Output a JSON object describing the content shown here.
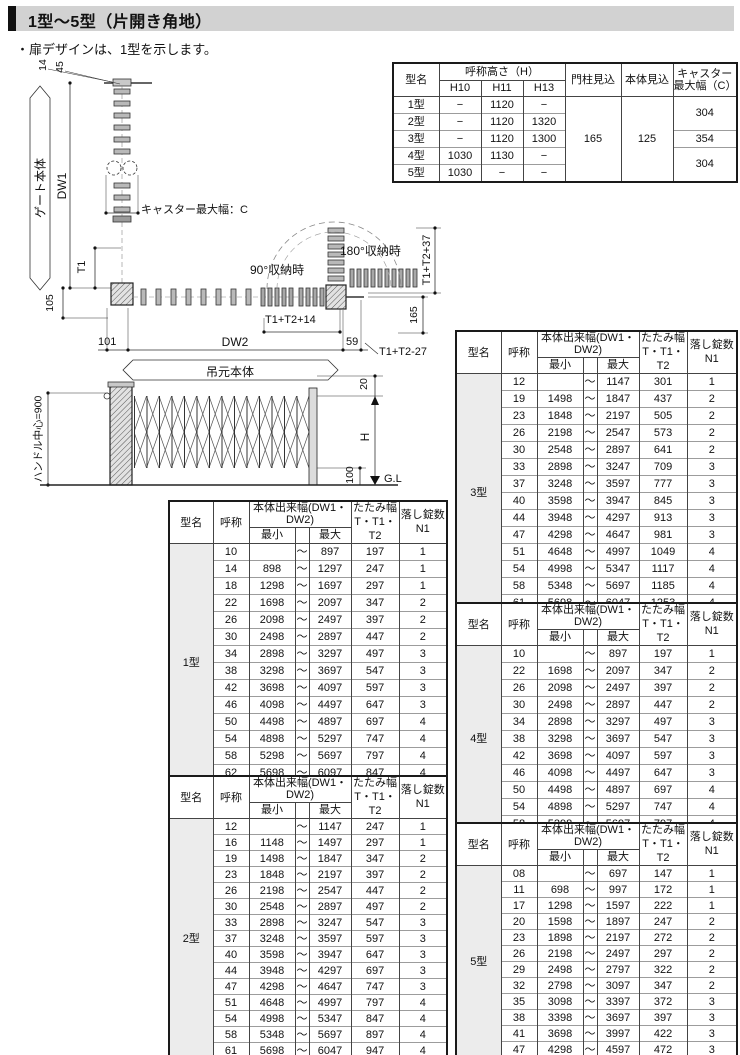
{
  "header": {
    "title": "1型～5型（片開き角地）",
    "note": "・扉デザインは、1型を示します。"
  },
  "spec_table": {
    "col_model": "型名",
    "col_height": "呼称高さ（H）",
    "sub_cols": [
      "H10",
      "H11",
      "H13"
    ],
    "col_pillar": "門柱見込",
    "col_body": "本体見込",
    "col_caster": "キャスター最大幅（C）",
    "rows": [
      [
        "1型",
        "−",
        "1120",
        "−"
      ],
      [
        "2型",
        "−",
        "1120",
        "1320"
      ],
      [
        "3型",
        "−",
        "1120",
        "1300"
      ],
      [
        "4型",
        "1030",
        "1130",
        "−"
      ],
      [
        "5型",
        "1030",
        "−",
        "−"
      ]
    ],
    "pillar": "165",
    "body": "125",
    "caster": [
      "304",
      "354",
      "304"
    ]
  },
  "diagram": {
    "gate_body": "ゲート本体",
    "dim14": "14",
    "dim45": "45",
    "dw1": "DW1",
    "caster_width": "キャスター最大幅：C",
    "t1": "T1",
    "dim105": "105",
    "store90": "90°収納時",
    "store180": "180°収納時",
    "t1t2p37": "T1+T2+37",
    "t1t2p14": "T1+T2+14",
    "dim165": "165",
    "dim101": "101",
    "dw2": "DW2",
    "dim59": "59",
    "t1t2m27": "T1+T2-27",
    "hang_body": "吊元本体",
    "handle_center": "ハンドル中心=900",
    "dim20": "20",
    "h": "H",
    "dim100": "100",
    "gl": "G.L"
  },
  "size_header": {
    "model": "型名",
    "name": "呼称",
    "width": "本体出来幅(DW1・DW2)",
    "min": "最小",
    "max": "最大",
    "fold1": "たたみ幅",
    "fold2": "T・T1・T2",
    "lock1": "落し錠数",
    "lock2": "N1",
    "tilde": "～"
  },
  "size_tables": [
    {
      "model": "1型",
      "rows": [
        [
          "10",
          "",
          "897",
          "197",
          "1"
        ],
        [
          "14",
          "898",
          "1297",
          "247",
          "1"
        ],
        [
          "18",
          "1298",
          "1697",
          "297",
          "1"
        ],
        [
          "22",
          "1698",
          "2097",
          "347",
          "2"
        ],
        [
          "26",
          "2098",
          "2497",
          "397",
          "2"
        ],
        [
          "30",
          "2498",
          "2897",
          "447",
          "2"
        ],
        [
          "34",
          "2898",
          "3297",
          "497",
          "3"
        ],
        [
          "38",
          "3298",
          "3697",
          "547",
          "3"
        ],
        [
          "42",
          "3698",
          "4097",
          "597",
          "3"
        ],
        [
          "46",
          "4098",
          "4497",
          "647",
          "3"
        ],
        [
          "50",
          "4498",
          "4897",
          "697",
          "4"
        ],
        [
          "54",
          "4898",
          "5297",
          "747",
          "4"
        ],
        [
          "58",
          "5298",
          "5697",
          "797",
          "4"
        ],
        [
          "62",
          "5698",
          "6097",
          "847",
          "4"
        ]
      ]
    },
    {
      "model": "2型",
      "rows": [
        [
          "12",
          "",
          "1147",
          "247",
          "1"
        ],
        [
          "16",
          "1148",
          "1497",
          "297",
          "1"
        ],
        [
          "19",
          "1498",
          "1847",
          "347",
          "2"
        ],
        [
          "23",
          "1848",
          "2197",
          "397",
          "2"
        ],
        [
          "26",
          "2198",
          "2547",
          "447",
          "2"
        ],
        [
          "30",
          "2548",
          "2897",
          "497",
          "2"
        ],
        [
          "33",
          "2898",
          "3247",
          "547",
          "3"
        ],
        [
          "37",
          "3248",
          "3597",
          "597",
          "3"
        ],
        [
          "40",
          "3598",
          "3947",
          "647",
          "3"
        ],
        [
          "44",
          "3948",
          "4297",
          "697",
          "3"
        ],
        [
          "47",
          "4298",
          "4647",
          "747",
          "3"
        ],
        [
          "51",
          "4648",
          "4997",
          "797",
          "4"
        ],
        [
          "54",
          "4998",
          "5347",
          "847",
          "4"
        ],
        [
          "58",
          "5348",
          "5697",
          "897",
          "4"
        ],
        [
          "61",
          "5698",
          "6047",
          "947",
          "4"
        ]
      ]
    },
    {
      "model": "3型",
      "rows": [
        [
          "12",
          "",
          "1147",
          "301",
          "1"
        ],
        [
          "19",
          "1498",
          "1847",
          "437",
          "2"
        ],
        [
          "23",
          "1848",
          "2197",
          "505",
          "2"
        ],
        [
          "26",
          "2198",
          "2547",
          "573",
          "2"
        ],
        [
          "30",
          "2548",
          "2897",
          "641",
          "2"
        ],
        [
          "33",
          "2898",
          "3247",
          "709",
          "3"
        ],
        [
          "37",
          "3248",
          "3597",
          "777",
          "3"
        ],
        [
          "40",
          "3598",
          "3947",
          "845",
          "3"
        ],
        [
          "44",
          "3948",
          "4297",
          "913",
          "3"
        ],
        [
          "47",
          "4298",
          "4647",
          "981",
          "3"
        ],
        [
          "51",
          "4648",
          "4997",
          "1049",
          "4"
        ],
        [
          "54",
          "4998",
          "5347",
          "1117",
          "4"
        ],
        [
          "58",
          "5348",
          "5697",
          "1185",
          "4"
        ],
        [
          "61",
          "5698",
          "6047",
          "1253",
          "4"
        ]
      ]
    },
    {
      "model": "4型",
      "rows": [
        [
          "10",
          "",
          "897",
          "197",
          "1"
        ],
        [
          "22",
          "1698",
          "2097",
          "347",
          "2"
        ],
        [
          "26",
          "2098",
          "2497",
          "397",
          "2"
        ],
        [
          "30",
          "2498",
          "2897",
          "447",
          "2"
        ],
        [
          "34",
          "2898",
          "3297",
          "497",
          "3"
        ],
        [
          "38",
          "3298",
          "3697",
          "547",
          "3"
        ],
        [
          "42",
          "3698",
          "4097",
          "597",
          "3"
        ],
        [
          "46",
          "4098",
          "4497",
          "647",
          "3"
        ],
        [
          "50",
          "4498",
          "4897",
          "697",
          "4"
        ],
        [
          "54",
          "4898",
          "5297",
          "747",
          "4"
        ],
        [
          "58",
          "5298",
          "5697",
          "797",
          "4"
        ]
      ]
    },
    {
      "model": "5型",
      "rows": [
        [
          "08",
          "",
          "697",
          "147",
          "1"
        ],
        [
          "11",
          "698",
          "997",
          "172",
          "1"
        ],
        [
          "17",
          "1298",
          "1597",
          "222",
          "1"
        ],
        [
          "20",
          "1598",
          "1897",
          "247",
          "2"
        ],
        [
          "23",
          "1898",
          "2197",
          "272",
          "2"
        ],
        [
          "26",
          "2198",
          "2497",
          "297",
          "2"
        ],
        [
          "29",
          "2498",
          "2797",
          "322",
          "2"
        ],
        [
          "32",
          "2798",
          "3097",
          "347",
          "2"
        ],
        [
          "35",
          "3098",
          "3397",
          "372",
          "3"
        ],
        [
          "38",
          "3398",
          "3697",
          "397",
          "3"
        ],
        [
          "41",
          "3698",
          "3997",
          "422",
          "3"
        ],
        [
          "47",
          "4298",
          "4597",
          "472",
          "3"
        ]
      ]
    }
  ]
}
